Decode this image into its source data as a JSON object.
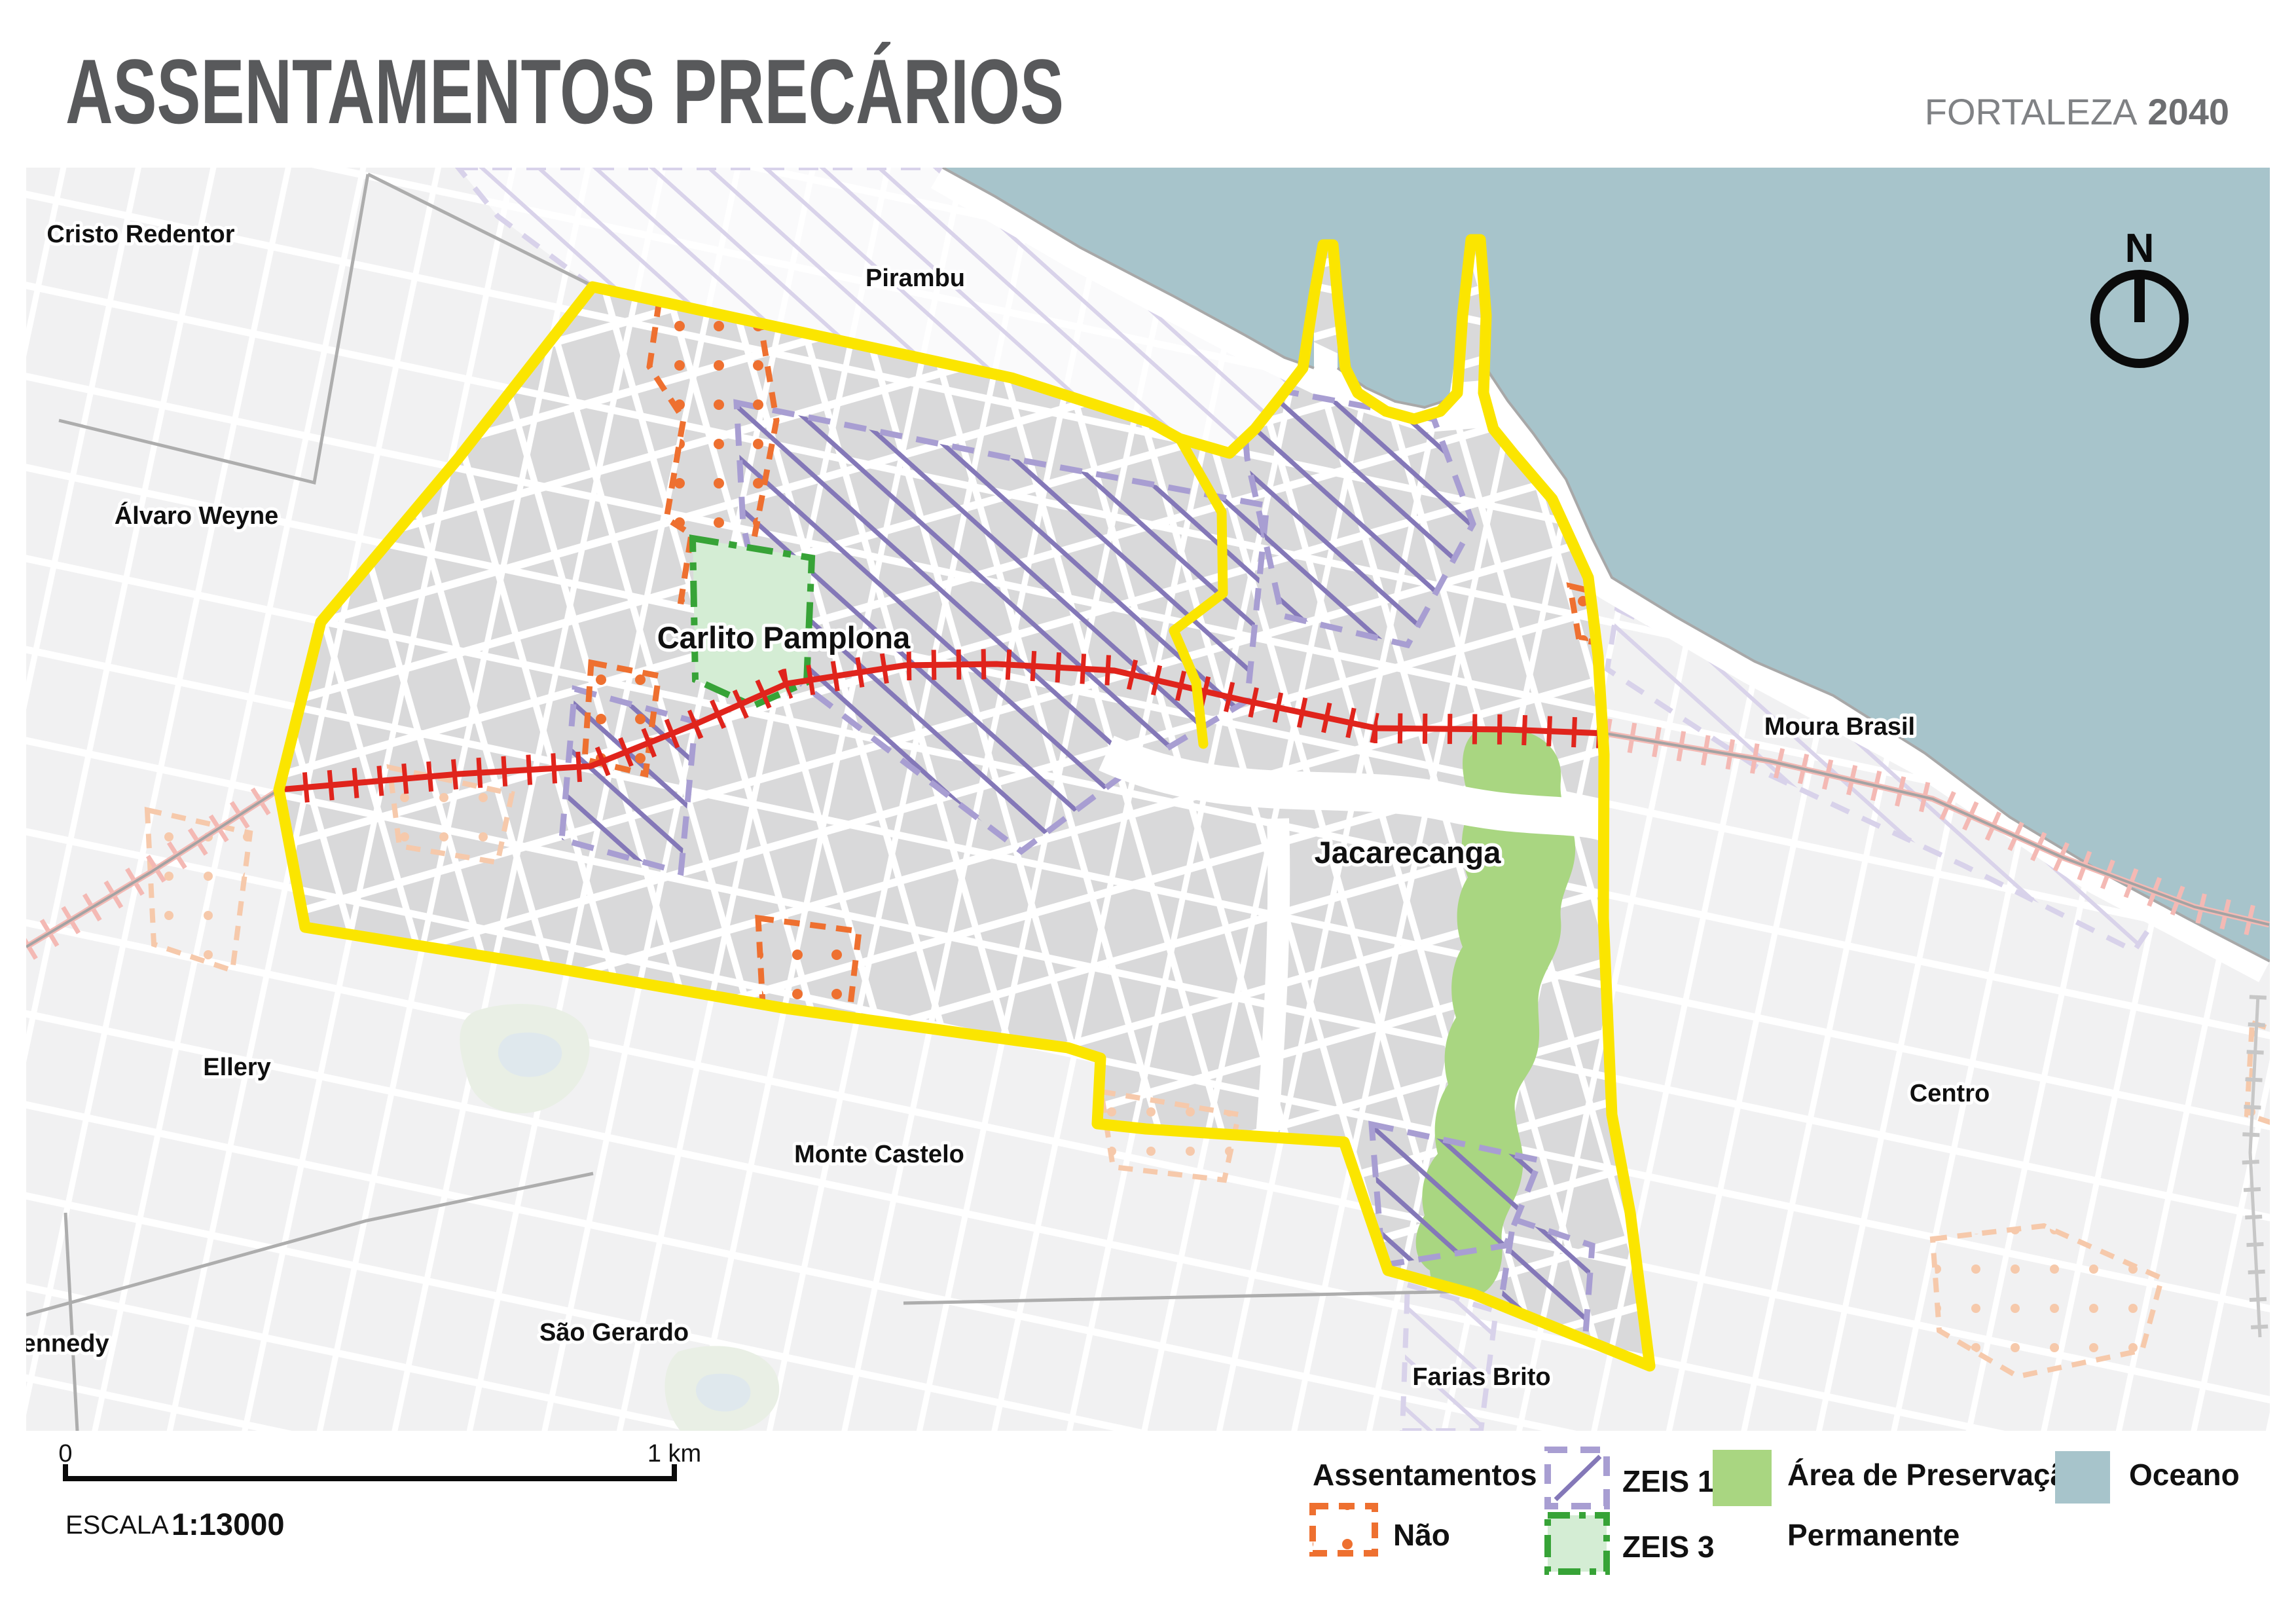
{
  "header": {
    "title": "ASSENTAMENTOS PRECÁRIOS",
    "brand": "FORTALEZA",
    "brand_year": "2040"
  },
  "north_label": "N",
  "scalebar": {
    "zero": "0",
    "one_km": "1 km",
    "escala_label": "ESCALA",
    "escala_value": "1:13000"
  },
  "legend": {
    "assentamentos": "Assentamentos",
    "nao": "Não",
    "zeis1": "ZEIS 1",
    "zeis3": "ZEIS 3",
    "app_line1": "Área de Preservação",
    "app_line2": "Permanente",
    "oceano": "Oceano"
  },
  "districts": [
    {
      "id": "cristo-redentor",
      "label": "Cristo Redentor"
    },
    {
      "id": "pirambu",
      "label": "Pirambu"
    },
    {
      "id": "alvaro-weyne",
      "label": "Álvaro Weyne"
    },
    {
      "id": "carlito-pamplona",
      "label": "Carlito Pamplona"
    },
    {
      "id": "moura-brasil",
      "label": "Moura Brasil"
    },
    {
      "id": "jacarecanga",
      "label": "Jacarecanga"
    },
    {
      "id": "ellery",
      "label": "Ellery"
    },
    {
      "id": "monte-castelo",
      "label": "Monte Castelo"
    },
    {
      "id": "centro",
      "label": "Centro"
    },
    {
      "id": "presidente-kennedy",
      "label": "ente Kennedy"
    },
    {
      "id": "sao-gerardo",
      "label": "São Gerardo"
    },
    {
      "id": "farias-brito",
      "label": "Farias Brito"
    }
  ],
  "colors": {
    "boundary": "#FBE500",
    "ocean": "#A7C4CB",
    "inside_fill": "#D9D9DA",
    "outside_fill": "#F1F1F2",
    "strip_fill": "#FAFAFB",
    "street": "#FFFFFF",
    "zeis1_hatch": "#8478B8",
    "zeis1_dash": "#A89ED2",
    "zeis1_faded": "#D8D2EA",
    "zeis3_border": "#37A337",
    "zeis3_fill": "#D4EDD4",
    "nao": "#EE7030",
    "nao_faded": "#F6C9AB",
    "preservation": "#A9D681",
    "railway": "#E0241C",
    "railway_faded": "#F4B9B4",
    "coastline": "#A8A8A8",
    "label": "#101010",
    "title": "#58595B",
    "brand": "#808285"
  }
}
